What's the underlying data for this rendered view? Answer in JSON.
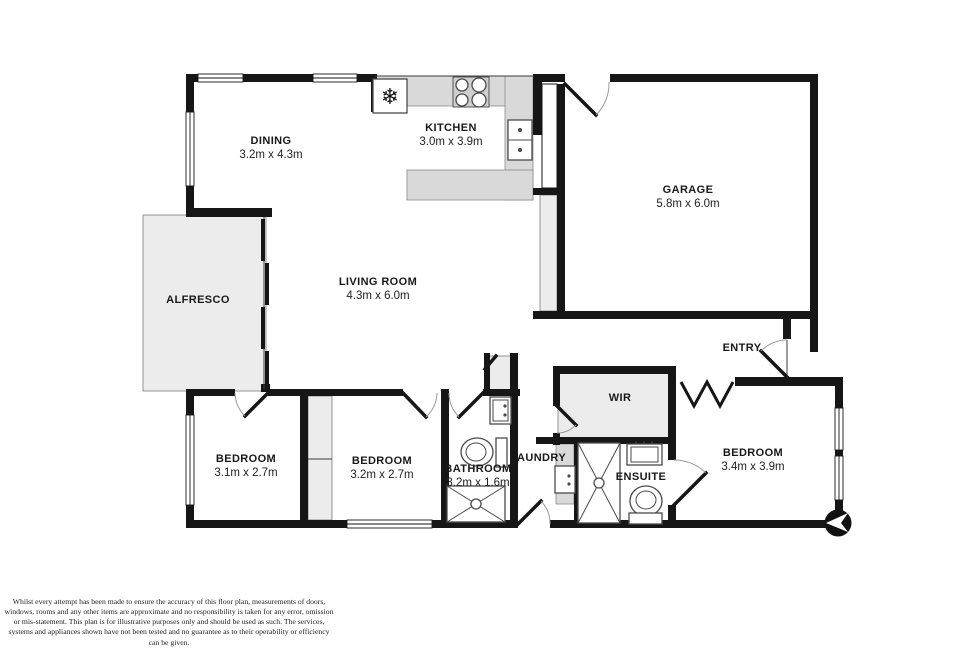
{
  "plan_title": "floor-plan",
  "rooms": [
    {
      "name": "DINING",
      "dims": "3.2m x 4.3m"
    },
    {
      "name": "KITCHEN",
      "dims": "3.0m x 3.9m"
    },
    {
      "name": "GARAGE",
      "dims": "5.8m x 6.0m"
    },
    {
      "name": "ALFRESCO",
      "dims": ""
    },
    {
      "name": "LIVING ROOM",
      "dims": "4.3m x 6.0m"
    },
    {
      "name": "WIR",
      "dims": ""
    },
    {
      "name": "ENTRY",
      "dims": ""
    },
    {
      "name": "BEDROOM",
      "dims": "3.1m x 2.7m"
    },
    {
      "name": "BEDROOM",
      "dims": "3.2m x 2.7m"
    },
    {
      "name": "BATHROOM",
      "dims": "3.2m x 1.6m"
    },
    {
      "name": "LAUNDRY",
      "dims": ""
    },
    {
      "name": "ENSUITE",
      "dims": ""
    },
    {
      "name": "BEDROOM",
      "dims": "3.4m x 3.9m"
    }
  ],
  "icons": [
    "fridge-snowflake-icon",
    "stove-burners-icon",
    "kitchen-sink-icon",
    "toilet-icon",
    "shower-icon",
    "vanity-basin-icon",
    "laundry-tub-icon",
    "compass-north-icon"
  ],
  "colors": {
    "wall": "#161616",
    "room_fill": "#ffffff",
    "soft_area": "#ececec",
    "counter": "#d9d9d9"
  },
  "disclaimer": "Whilst every attempt has been made to ensure the accuracy of this floor plan, measurements of doors, windows, rooms and any other items are approximate and no responsibility is taken for any error, omission or mis-statement. This plan is for illustrative purposes only and should be used as such. The services, systems and appliances shown have not been tested and no guarantee as to their operability or efficiency can be given."
}
